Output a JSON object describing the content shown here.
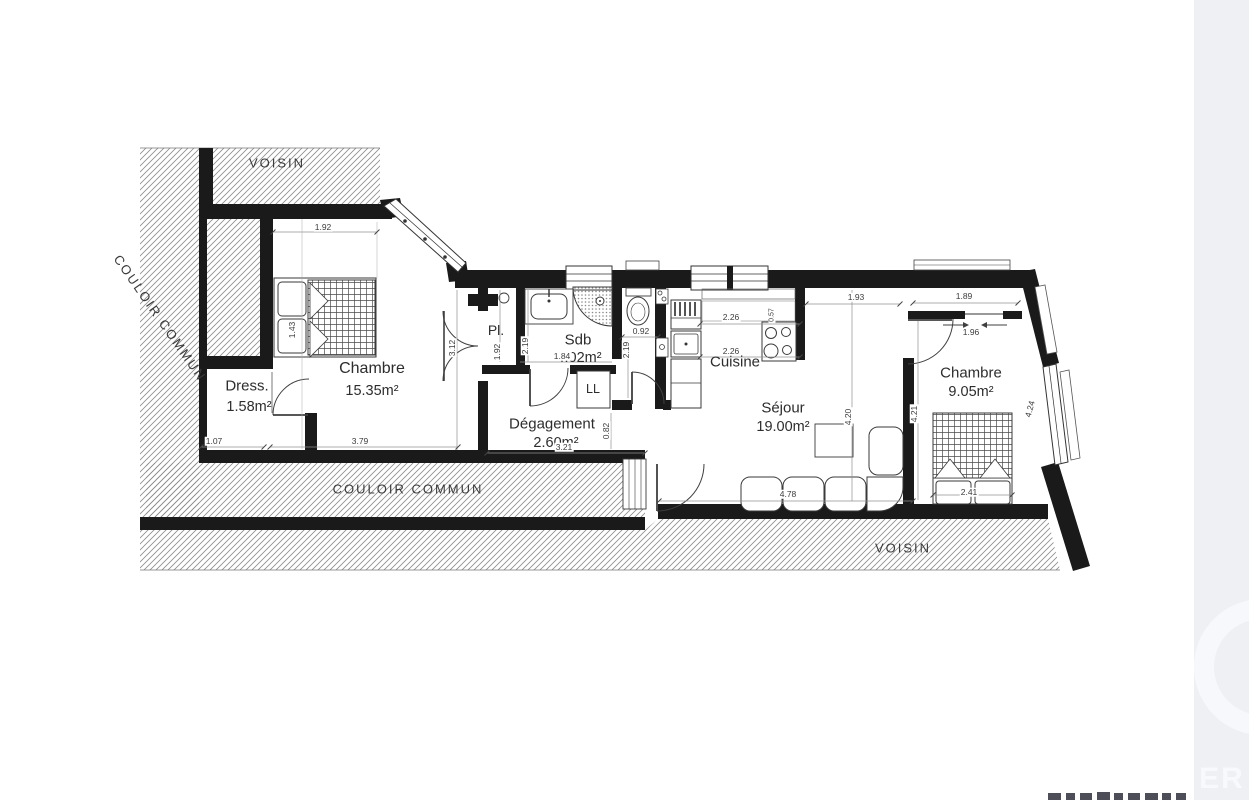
{
  "canvas": {
    "background": "#ffffff",
    "wall_color": "#1a1a1a",
    "hatch_line_color": "#8c8c8c",
    "right_panel_color": "#eef0f4"
  },
  "watermark": {
    "letters": "ER"
  },
  "exterior": {
    "voisin_top": "VOISIN",
    "voisin_bottom": "VOISIN",
    "couloir_left": "COULOIR COMMUN",
    "couloir_bottom": "COULOIR COMMUN"
  },
  "rooms": {
    "chambre1": {
      "name": "Chambre",
      "area": "15.35m²"
    },
    "dress": {
      "name": "Dress.",
      "area": "1.58m²"
    },
    "placard": {
      "name": "Pl."
    },
    "sdb": {
      "name": "Sdb",
      "area": "4.02m²"
    },
    "washer": {
      "label": "LL"
    },
    "degagement": {
      "name": "Dégagement",
      "area": "2.60m²"
    },
    "cuisine": {
      "name": "Cuisine"
    },
    "sejour": {
      "name": "Séjour",
      "area": "19.00m²"
    },
    "chambre2": {
      "name": "Chambre",
      "area": "9.05m²"
    }
  },
  "dimensions": {
    "top_chambre1": "1.92",
    "bed1_width": "1.43",
    "dress_width": "1.07",
    "chambre1_width": "3.79",
    "chambre1_height": "3.12",
    "pl_height": "1.92",
    "sdb_left": "2.19",
    "sdb_width": "1.84",
    "wc_width": "0.92",
    "wc_height": "2.19",
    "deg_width": "3.21",
    "deg_height": "0.82",
    "cuisine_top": "2.26",
    "cuisine_mid": "2.26",
    "stove_width": "0.57",
    "sejour_top": "1.93",
    "chambre2_top": "1.89",
    "slide_width": "1.96",
    "sejour_height": "4.20",
    "chambre2_height": "4.21",
    "slant_height": "4.24",
    "sejour_width": "4.78",
    "bed2_width": "2.41"
  }
}
